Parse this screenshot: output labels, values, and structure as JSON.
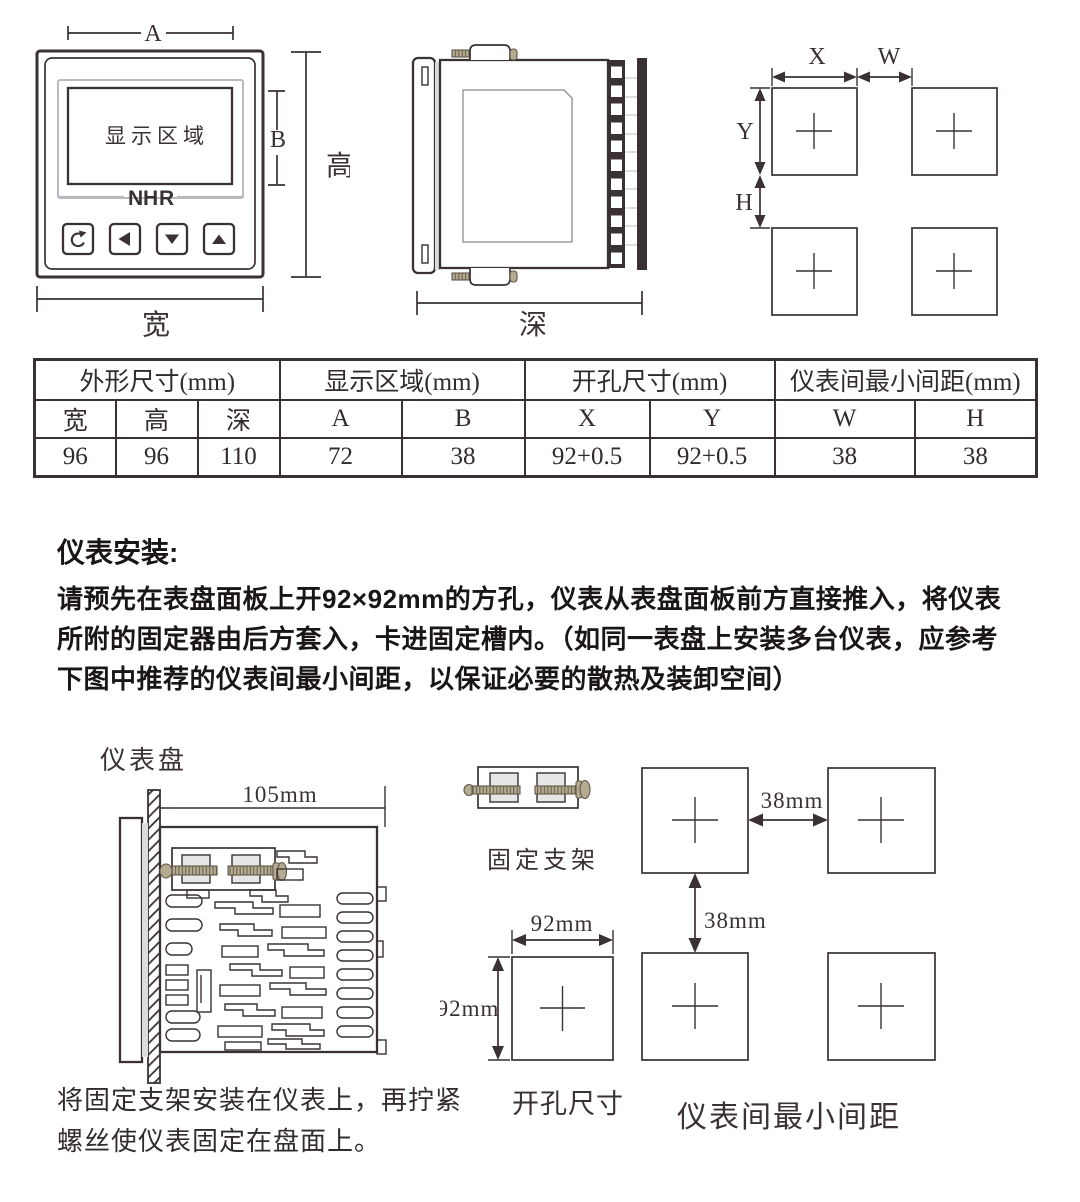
{
  "colors": {
    "ink": "#3a3132",
    "logo_red": "#d9402e",
    "logo_gray": "#b5b8bc"
  },
  "front_view": {
    "display_label": "显示区域",
    "logo": {
      "n": "N",
      "h": "H",
      "r": "R"
    },
    "dims": {
      "a": "A",
      "b": "B",
      "height": "高",
      "width": "宽"
    },
    "buttons": [
      {
        "icon": "return-arrow"
      },
      {
        "icon": "left-triangle"
      },
      {
        "icon": "down-triangle"
      },
      {
        "icon": "up-triangle"
      }
    ]
  },
  "side_view": {
    "dims": {
      "depth": "深"
    }
  },
  "cutout_view": {
    "dims": {
      "x": "X",
      "w": "W",
      "y": "Y",
      "h": "H"
    }
  },
  "spec_table": {
    "groups": [
      {
        "label": "外形尺寸(mm)",
        "cols": [
          "宽",
          "高",
          "深"
        ],
        "values": [
          "96",
          "96",
          "110"
        ]
      },
      {
        "label": "显示区域(mm)",
        "cols": [
          "A",
          "B"
        ],
        "values": [
          "72",
          "38"
        ]
      },
      {
        "label": "开孔尺寸(mm)",
        "cols": [
          "X",
          "Y"
        ],
        "values": [
          "92+0.5",
          "92+0.5"
        ]
      },
      {
        "label": "仪表间最小间距(mm)",
        "cols": [
          "W",
          "H"
        ],
        "values": [
          "38",
          "38"
        ]
      }
    ]
  },
  "install": {
    "title": "仪表安装:",
    "lines": [
      "请预先在表盘面板上开92×92mm的方孔，仪表从表盘面板前方直接推入，将仪表",
      "所附的固定器由后方套入，卡进固定槽内。（如同一表盘上安装多台仪表，应参考",
      "下图中推荐的仪表间最小间距，以保证必要的散热及装卸空间）"
    ]
  },
  "mounting": {
    "panel_label": "仪表盘",
    "depth_dim": "105mm",
    "bracket_label": "固定支架",
    "hole_w": "92mm",
    "hole_h": "92mm",
    "hole_caption": "开孔尺寸",
    "gap_w": "38mm",
    "gap_h": "38mm",
    "spacing_caption": "仪表间最小间距",
    "note_lines": [
      "将固定支架安装在仪表上，再拧紧",
      "螺丝使仪表固定在盘面上。"
    ]
  }
}
